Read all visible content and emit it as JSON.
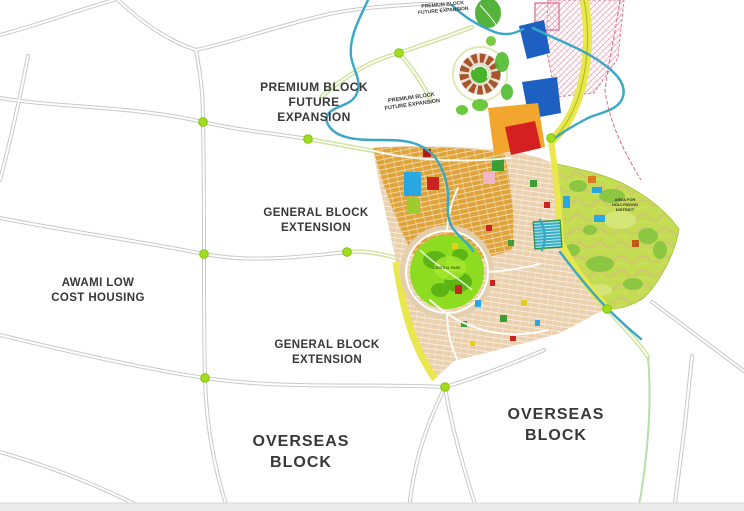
{
  "map": {
    "type": "housing-society-master-plan",
    "labels": {
      "premium_main": "PREMIUM BLOCK\nFUTURE\nEXPANSION",
      "premium_tiny_top": "PREMIUM BLOCK\nFUTURE EXPANSION",
      "premium_tiny_mid": "PREMIUM BLOCK\nFUTURE EXPANSION",
      "general_upper": "GENERAL BLOCK\nEXTENSION",
      "awami": "AWAMI LOW\nCOST HOUSING",
      "general_lower": "GENERAL BLOCK\nEXTENSION",
      "overseas_left": "OVERSEAS\nBLOCK",
      "overseas_right": "OVERSEAS\nBLOCK",
      "hills_tiny": "AREA FOR\nHOLLYWOOD\nDISTRICT",
      "park_tiny": "CENTRAL PARK"
    },
    "colors": {
      "background": "#ffffff",
      "road_gray": "#c9c9c9",
      "road_green_casing": "#cfe49e",
      "highway_yellow": "#e9e74b",
      "junction_dot_green": "#9fdd1e",
      "river_blue": "#39a7c5",
      "residential_orange": "#dfa33a",
      "residential_tan": "#ead0ac",
      "hill_district_green": "#c4dc52",
      "central_park_green": "#8edc1f",
      "block_blue": "#1e5fc2",
      "block_red": "#d42020",
      "expansion_hatch_pink": "#eba8bc",
      "label_text": "#383838"
    }
  }
}
